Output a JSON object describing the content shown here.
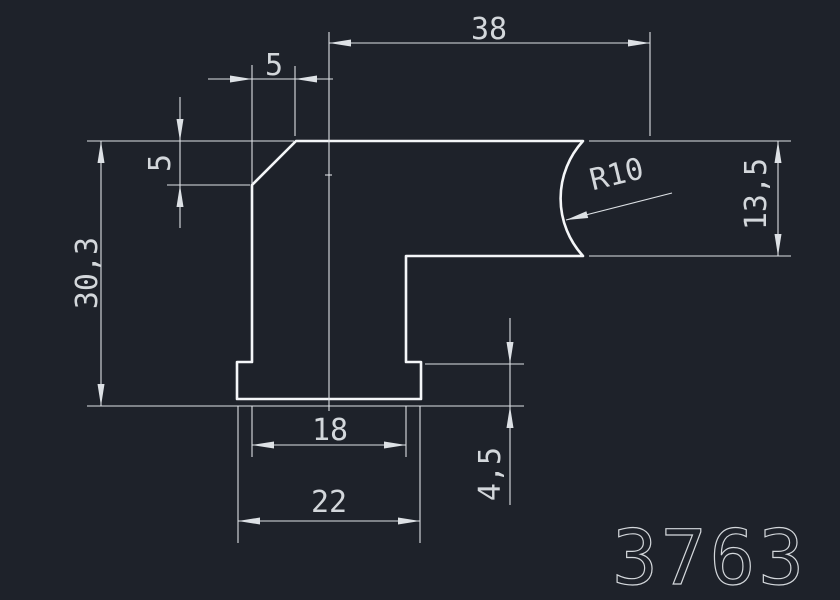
{
  "drawing": {
    "background_color": "#1e222a",
    "outline_color": "#f4f6f8",
    "dimension_color": "#dde1e5",
    "text_color": "#d3d7db",
    "part_number": "3763",
    "dimensions": {
      "top_width": "38",
      "chamfer_width": "5",
      "chamfer_height": "5",
      "overall_height": "30,3",
      "radius": "R10",
      "right_arm_height": "13,5",
      "stem_width": "18",
      "base_width": "22",
      "base_height": "4,5"
    }
  }
}
